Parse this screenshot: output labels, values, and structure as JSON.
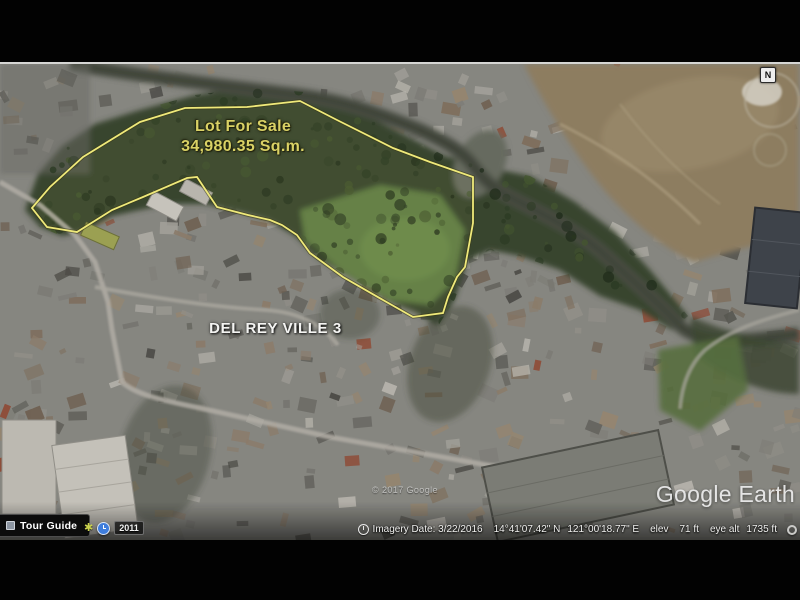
{
  "overlay": {
    "lot_label_line1": "Lot For Sale",
    "lot_label_line2": "34,980.35 Sq.m.",
    "subdivision_label": "DEL REY VILLE 3",
    "label_color": "#d9d165",
    "lot_outline_color": "#efe97a"
  },
  "watermark": {
    "copyright": "© 2017 Google",
    "brand": "Google Earth"
  },
  "status_bar": {
    "imagery_date": "Imagery Date: 3/22/2016",
    "latitude": "14°41'07.42\" N",
    "longitude": "121°00'18.77\" E",
    "elev_label": "elev",
    "elev_value": "71 ft",
    "eye_alt_label": "eye alt",
    "eye_alt_value": "1735 ft"
  },
  "toolbar": {
    "tour_guide_label": "Tour Guide",
    "history_year": "2011"
  },
  "compass": {
    "north_label": "N"
  }
}
